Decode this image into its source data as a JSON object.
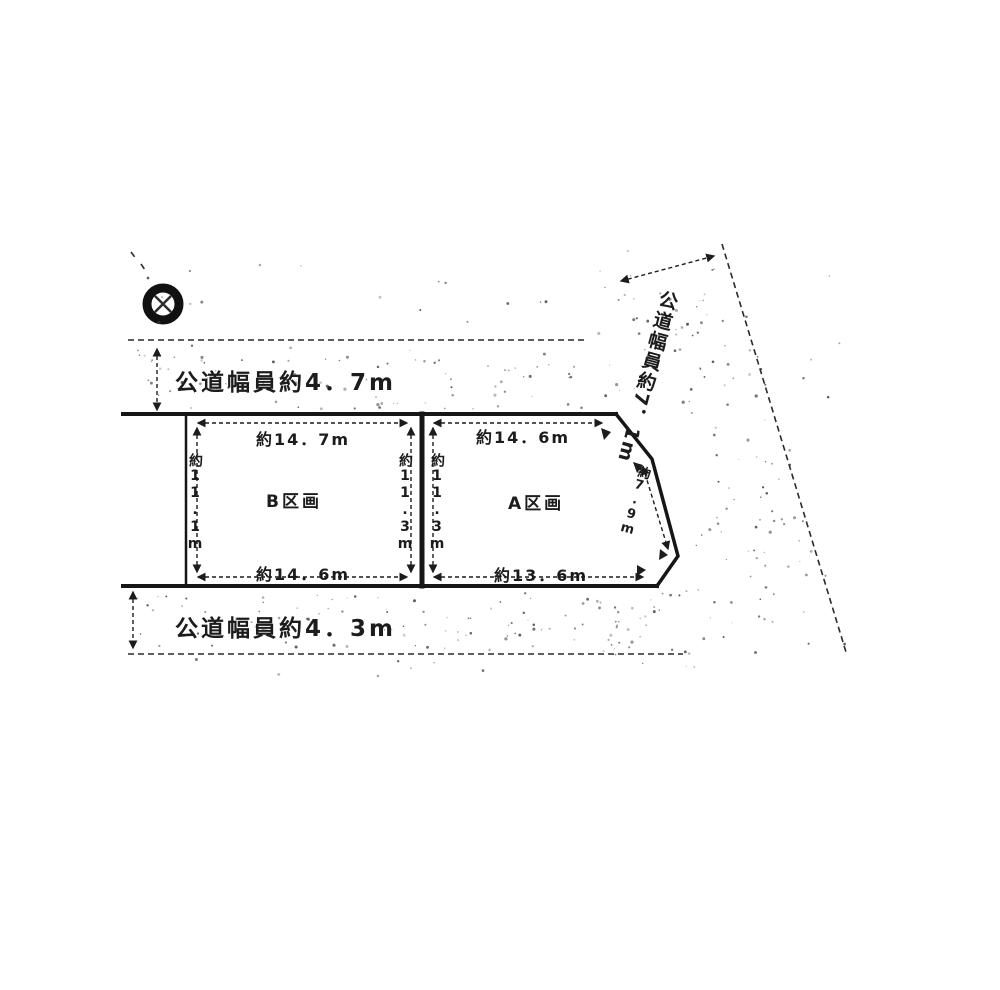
{
  "roads": {
    "top_label": "公道幅員約4．7m",
    "bottom_label": "公道幅員約4．3m",
    "right_label": "公道幅員約7．1m"
  },
  "plot_b": {
    "name": "B区画",
    "dim_top": "約14．7m",
    "dim_bottom": "約14．6m",
    "dim_left": "約11.1m",
    "dim_right": "約11.3m"
  },
  "plot_a": {
    "name": "A区画",
    "dim_top": "約14．6m",
    "dim_bottom": "約13．6m",
    "dim_left": "約11.3m",
    "dim_right_slant": "約7.9m"
  },
  "symbols": {
    "pole_marker": "utility-pole-circle-x"
  },
  "colors": {
    "ink": "#1c1c1c",
    "paper": "#ffffff",
    "stipple": "#3a3a3a"
  }
}
